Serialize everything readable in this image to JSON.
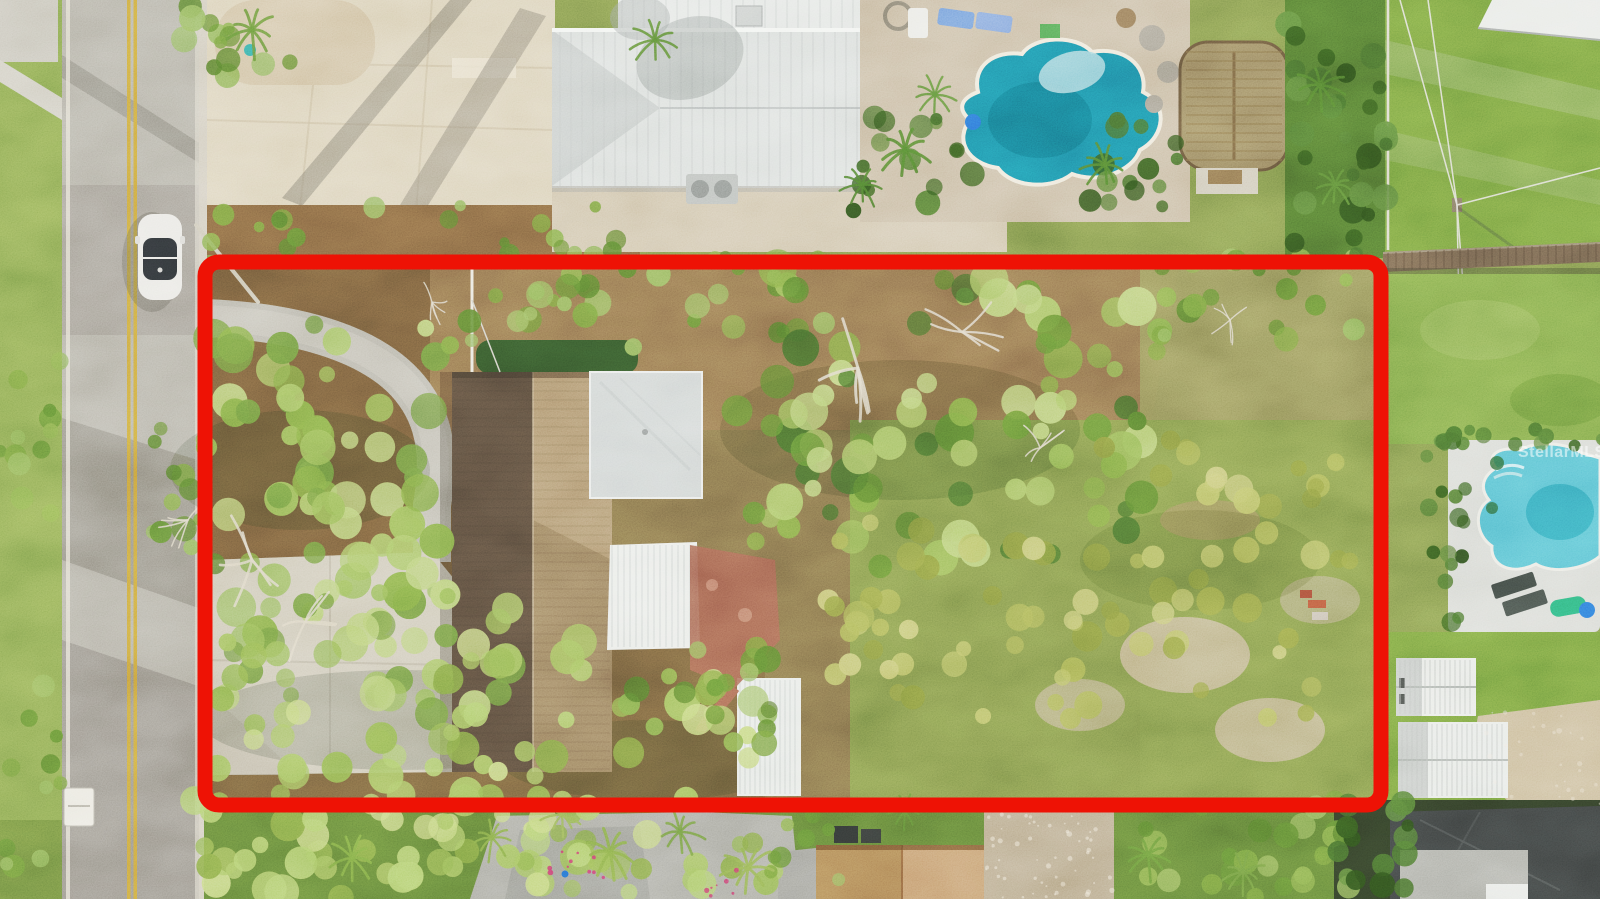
{
  "meta": {
    "description": "Aerial drone photo of a residential lot outlined in red, bordered by a two-lane road on the left and neighboring homes with swimming pools",
    "image_type": "aerial-photo"
  },
  "watermark": {
    "text": "StellarMLS"
  },
  "property_outline": {
    "color": "#ee1205",
    "x": 205,
    "y": 262,
    "width": 1176,
    "height": 543,
    "stroke_width": 15,
    "corner_radius": 14
  },
  "colors": {
    "road_asphalt": "#b0ada1",
    "road_yellow_line": "#c79f3d",
    "concrete_driveway": "#d9cfb5",
    "metal_roof": "#dfe3e0",
    "shingle_roof": "#8a7355",
    "pool_water_deep": "#1f86a0",
    "pool_water_light": "#56bccd",
    "lawn": "#6f9a3e",
    "dirt": "#8a6c4a",
    "sand_path": "#c6b691",
    "tarp": "#3c403f"
  },
  "landmarks": {
    "road": "two-lane road with double yellow centerline",
    "car": "white sedan parked on road",
    "outlined_lot": "overgrown lot with single-family home and curved driveway",
    "top_neighbor": "house with standing-seam metal roof and freeform pool",
    "right_neighbor": "lawn with pool, wood fence and two white sheds",
    "tiki_hut": "thatched palapa beside the top pool"
  }
}
